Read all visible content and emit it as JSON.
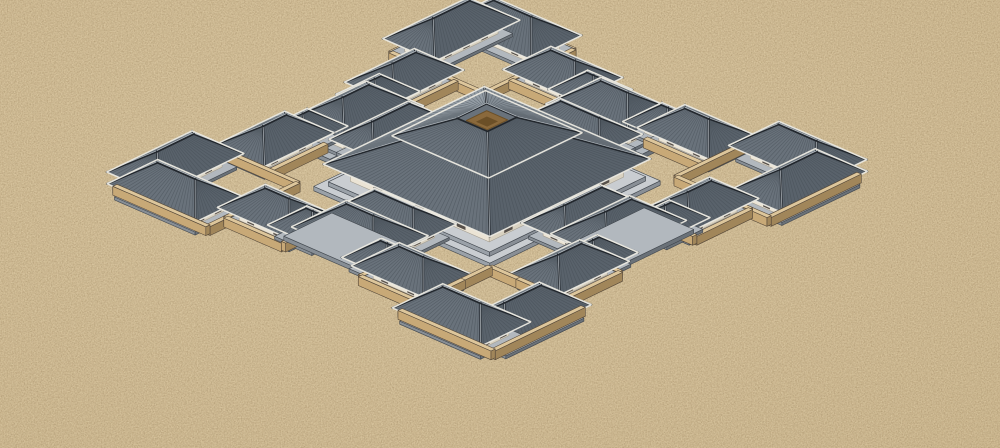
{
  "app": {
    "title": "3d-architectural-model-render",
    "subject": "walled ritual palace complex on sand"
  },
  "scene": {
    "canvas": {
      "width": 1000,
      "height": 448
    },
    "projection": {
      "cx": 487,
      "cy": 188,
      "ux": 60,
      "uy": -29,
      "vx": 62,
      "vy": 27,
      "zs": 44
    },
    "style": {
      "stripe_px": 4.0,
      "wall_thickness": 0.07,
      "wall_height": 0.2,
      "plinth_pad": 0.1,
      "plinth_height": 0.07,
      "eave_overhang": 0.16,
      "gate_platform_height": 0.1
    },
    "palette": {
      "sand": "#ccb68e",
      "sand_light": "#d6c29c",
      "speckle_dark": "#8a7450",
      "speckle_light": "#efe3bf",
      "wall_top": "#ddc69b",
      "wall_lit": "#c8a977",
      "wall_shade": "#a1865a",
      "wall_line": "#554839",
      "plinth_top": "#b2b8be",
      "plinth_lit": "#878e95",
      "plinth_shade": "#6a7178",
      "plinth_line": "#41474e",
      "white_lit": "#ebe4d5",
      "white_shade": "#d9d2c1",
      "white_line": "#a39d90",
      "door": "#57504a",
      "roofN": "#939CA4",
      "roofE": "#848D95",
      "roofW": "#69727B",
      "roofS": "#59626B",
      "stripe": "#434B53",
      "ridge": "#22272D",
      "ridge_highlight": "#C9CFD5",
      "eave": "#EDEBE3",
      "terrace_top": "#c9cdd1",
      "terrace_lit": "#9aa1a8",
      "terrace_shade": "#898f96",
      "atrium": "#8a693c",
      "atrium_inner": "#6b4f27"
    },
    "perimeter_courts": [
      [
        "north-side-court-a",
        -1.55,
        -2.75,
        -0.62,
        -2.0
      ],
      [
        "north-side-court-b",
        0.62,
        -2.75,
        1.55,
        -2.0
      ],
      [
        "south-side-court-a",
        -1.55,
        2.0,
        -0.62,
        2.75
      ],
      [
        "south-side-court-b",
        0.62,
        2.0,
        1.55,
        2.75
      ],
      [
        "east-side-court-a",
        2.0,
        -1.55,
        2.75,
        -0.62
      ],
      [
        "east-side-court-b",
        2.0,
        0.62,
        2.75,
        1.55
      ],
      [
        "west-side-court-a",
        -2.75,
        -1.55,
        -2.0,
        -0.62
      ],
      [
        "west-side-court-b",
        -2.75,
        0.62,
        -2.0,
        1.55
      ],
      [
        "top-corner-court",
        1.55,
        -3.05,
        3.05,
        -1.55
      ],
      [
        "right-corner-court",
        1.55,
        1.55,
        3.05,
        3.05
      ],
      [
        "bottom-corner-court",
        -3.05,
        1.55,
        -1.55,
        3.05
      ],
      [
        "left-corner-court",
        -3.05,
        -3.05,
        -1.55,
        -1.55
      ]
    ],
    "gate_platforms": [
      [
        "north-gate-platform",
        -0.8,
        -2.56,
        0.8,
        -1.76
      ],
      [
        "south-gate-platform",
        -0.8,
        1.76,
        0.8,
        2.56
      ],
      [
        "east-gate-platform",
        1.76,
        -0.8,
        2.56,
        0.8
      ],
      [
        "west-gate-platform",
        -2.56,
        -0.8,
        -1.76,
        0.8
      ]
    ],
    "buildings": [
      [
        "north-gatehouse",
        0,
        -2.12,
        0.5,
        0.3,
        "x",
        0.34,
        0.5
      ],
      [
        "south-gatehouse",
        0,
        2.12,
        0.5,
        0.3,
        "x",
        0.34,
        0.5
      ],
      [
        "east-gatehouse",
        2.12,
        0,
        0.5,
        0.3,
        "y",
        0.34,
        0.5
      ],
      [
        "west-gatehouse",
        -2.12,
        0,
        0.5,
        0.3,
        "y",
        0.34,
        0.5
      ],
      [
        "north-gate-kiosk-a",
        -0.6,
        -2.34,
        0.2,
        0.17,
        "x",
        0.26,
        0.36
      ],
      [
        "north-gate-kiosk-b",
        0.6,
        -2.34,
        0.2,
        0.17,
        "x",
        0.26,
        0.36
      ],
      [
        "south-gate-kiosk-a",
        -0.6,
        2.34,
        0.2,
        0.17,
        "x",
        0.26,
        0.36
      ],
      [
        "south-gate-kiosk-b",
        0.6,
        2.34,
        0.2,
        0.17,
        "x",
        0.26,
        0.36
      ],
      [
        "east-gate-kiosk-a",
        2.34,
        -0.6,
        0.2,
        0.17,
        "y",
        0.26,
        0.36
      ],
      [
        "east-gate-kiosk-b",
        2.34,
        0.6,
        0.2,
        0.17,
        "y",
        0.26,
        0.36
      ],
      [
        "west-gate-kiosk-a",
        -2.34,
        -0.6,
        0.2,
        0.17,
        "y",
        0.26,
        0.36
      ],
      [
        "west-gate-kiosk-b",
        -2.34,
        0.6,
        0.2,
        0.17,
        "y",
        0.26,
        0.36
      ],
      [
        "north-flanking-hall",
        0,
        -1.55,
        0.5,
        0.2,
        "x",
        0.3,
        0.4
      ],
      [
        "south-flanking-hall",
        0,
        1.55,
        0.5,
        0.2,
        "x",
        0.3,
        0.4
      ],
      [
        "east-flanking-hall",
        1.55,
        0,
        0.5,
        0.2,
        "y",
        0.3,
        0.4
      ],
      [
        "west-flanking-hall",
        -1.55,
        0,
        0.5,
        0.2,
        "y",
        0.3,
        0.4
      ],
      [
        "north-court-house-a",
        -1.08,
        -2.38,
        0.42,
        0.24,
        "x",
        0.3,
        0.42
      ],
      [
        "north-court-house-b",
        1.08,
        -2.38,
        0.42,
        0.24,
        "x",
        0.3,
        0.42
      ],
      [
        "south-court-house-a",
        -1.08,
        2.38,
        0.42,
        0.24,
        "x",
        0.3,
        0.42
      ],
      [
        "south-court-house-b",
        1.08,
        2.38,
        0.42,
        0.24,
        "x",
        0.3,
        0.42
      ],
      [
        "east-court-house-a",
        2.38,
        -1.08,
        0.42,
        0.24,
        "y",
        0.3,
        0.42
      ],
      [
        "east-court-house-b",
        2.38,
        1.08,
        0.42,
        0.24,
        "y",
        0.3,
        0.42
      ],
      [
        "west-court-house-a",
        -2.38,
        -1.08,
        0.42,
        0.24,
        "y",
        0.3,
        0.42
      ],
      [
        "west-court-house-b",
        -2.38,
        1.08,
        0.42,
        0.24,
        "y",
        0.3,
        0.42
      ],
      [
        "top-corner-wing-a",
        2.3,
        -2.8,
        0.55,
        0.26,
        "x",
        0.3,
        0.46
      ],
      [
        "top-corner-wing-b",
        2.8,
        -2.3,
        0.55,
        0.26,
        "y",
        0.3,
        0.46
      ],
      [
        "right-corner-wing-a",
        2.3,
        2.8,
        0.55,
        0.26,
        "x",
        0.3,
        0.46
      ],
      [
        "right-corner-wing-b",
        2.8,
        2.3,
        0.55,
        0.26,
        "y",
        0.3,
        0.46
      ],
      [
        "bottom-corner-wing-a",
        -2.3,
        2.8,
        0.55,
        0.26,
        "x",
        0.3,
        0.46
      ],
      [
        "bottom-corner-wing-b",
        -2.8,
        2.3,
        0.55,
        0.26,
        "y",
        0.3,
        0.46
      ],
      [
        "left-corner-wing-a",
        -2.3,
        -2.8,
        0.55,
        0.26,
        "x",
        0.3,
        0.46
      ],
      [
        "left-corner-wing-b",
        -2.8,
        -2.3,
        0.55,
        0.26,
        "y",
        0.3,
        0.46
      ]
    ],
    "hall": {
      "name": "central-hall",
      "terrace1": [
        1.42,
        0.1
      ],
      "terrace2": [
        1.3,
        0.2
      ],
      "wall_half": 1.12,
      "wall_top": 0.6,
      "lower_eave": [
        1.34,
        0.6
      ],
      "lower_top": [
        0.66,
        1.14
      ],
      "clerestory": [
        0.6,
        1.24
      ],
      "upper_eave": [
        0.78,
        1.22
      ],
      "upper_top": [
        0.24,
        1.6
      ],
      "atrium_mid": 0.17,
      "atrium_inner": 0.09,
      "door_count_front": 5,
      "door_count_side": 3
    }
  }
}
